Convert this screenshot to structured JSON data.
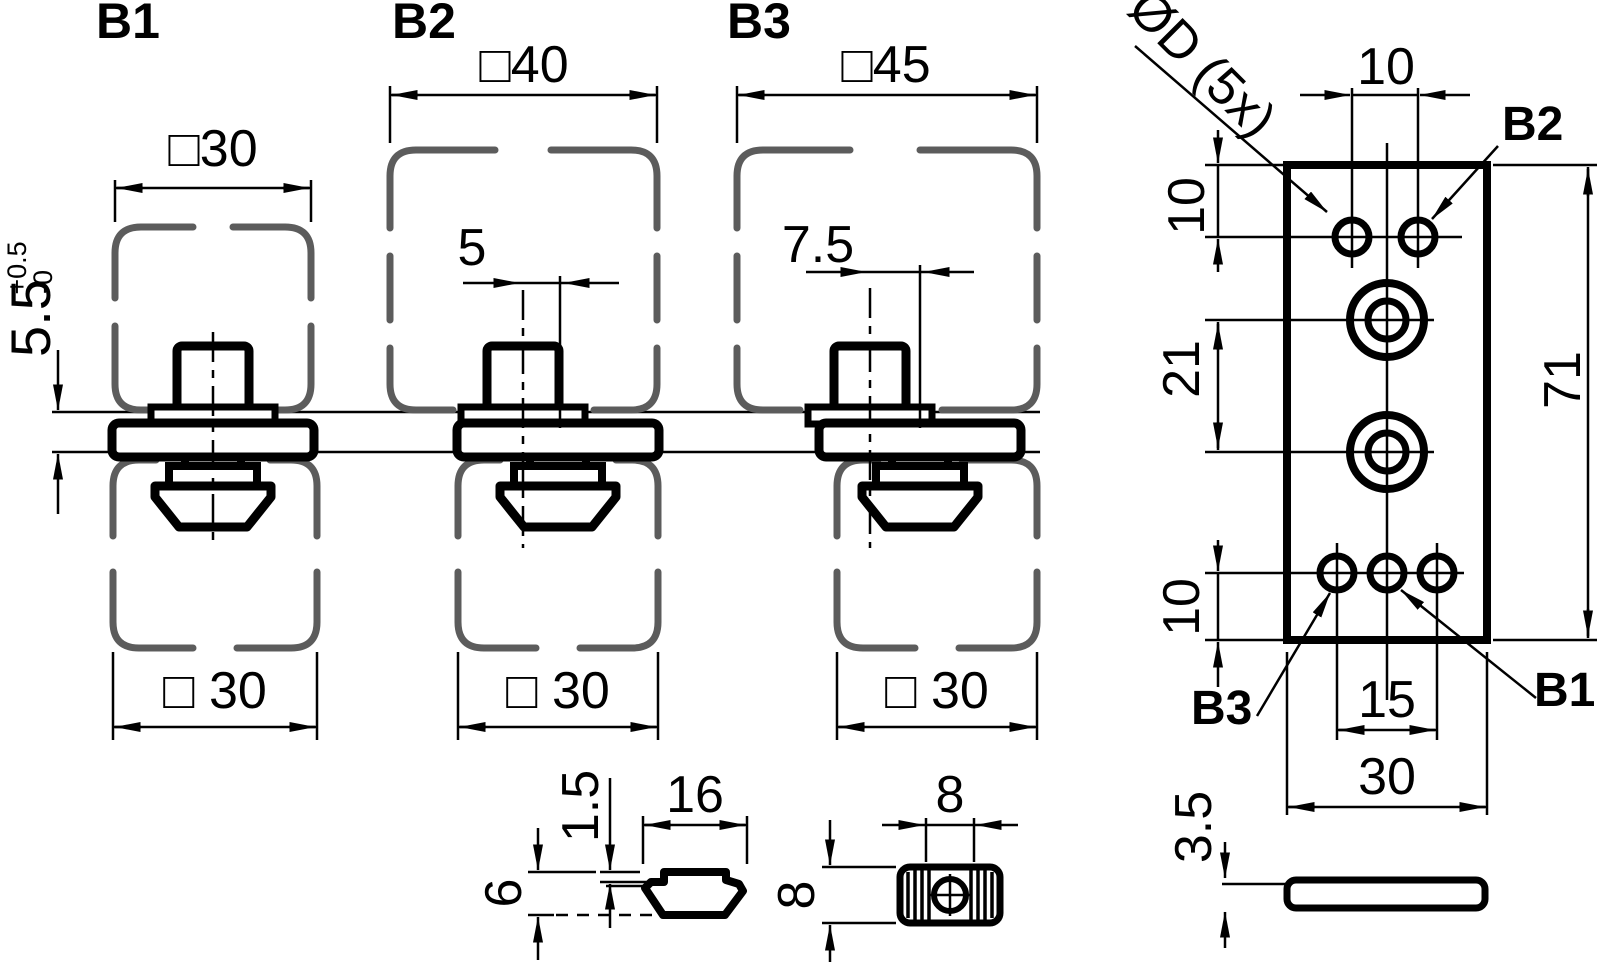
{
  "b1": {
    "label": "B1",
    "upper_profile": "□30",
    "protrusion": "5.5",
    "protrusion_tol_plus": "+0.5",
    "protrusion_tol_minus": "-0",
    "lower_profile": "□ 30"
  },
  "b2": {
    "label": "B2",
    "upper_profile": "□40",
    "offset": "5",
    "lower_profile": "□ 30"
  },
  "b3": {
    "label": "B3",
    "upper_profile": "□45",
    "offset": "7.5",
    "lower_profile": "□ 30"
  },
  "nut_side_view": {
    "lip": "1.5",
    "width": "16",
    "height": "6"
  },
  "nut_front_view": {
    "width": "8",
    "height": "8"
  },
  "plate": {
    "holes_label": "ØD (5x)",
    "top_hole_spacing": "10",
    "top_edge_distance": "10",
    "counterbore_spacing": "21",
    "height": "71",
    "bottom_edge_distance": "10",
    "bottom_hole_spacing": "15",
    "width": "30",
    "thickness": "3.5",
    "ref_b1": "B1",
    "ref_b2": "B2",
    "ref_b3": "B3"
  },
  "colors": {
    "line": "#000000",
    "profile": "#5c5c5c",
    "background": "#ffffff"
  }
}
